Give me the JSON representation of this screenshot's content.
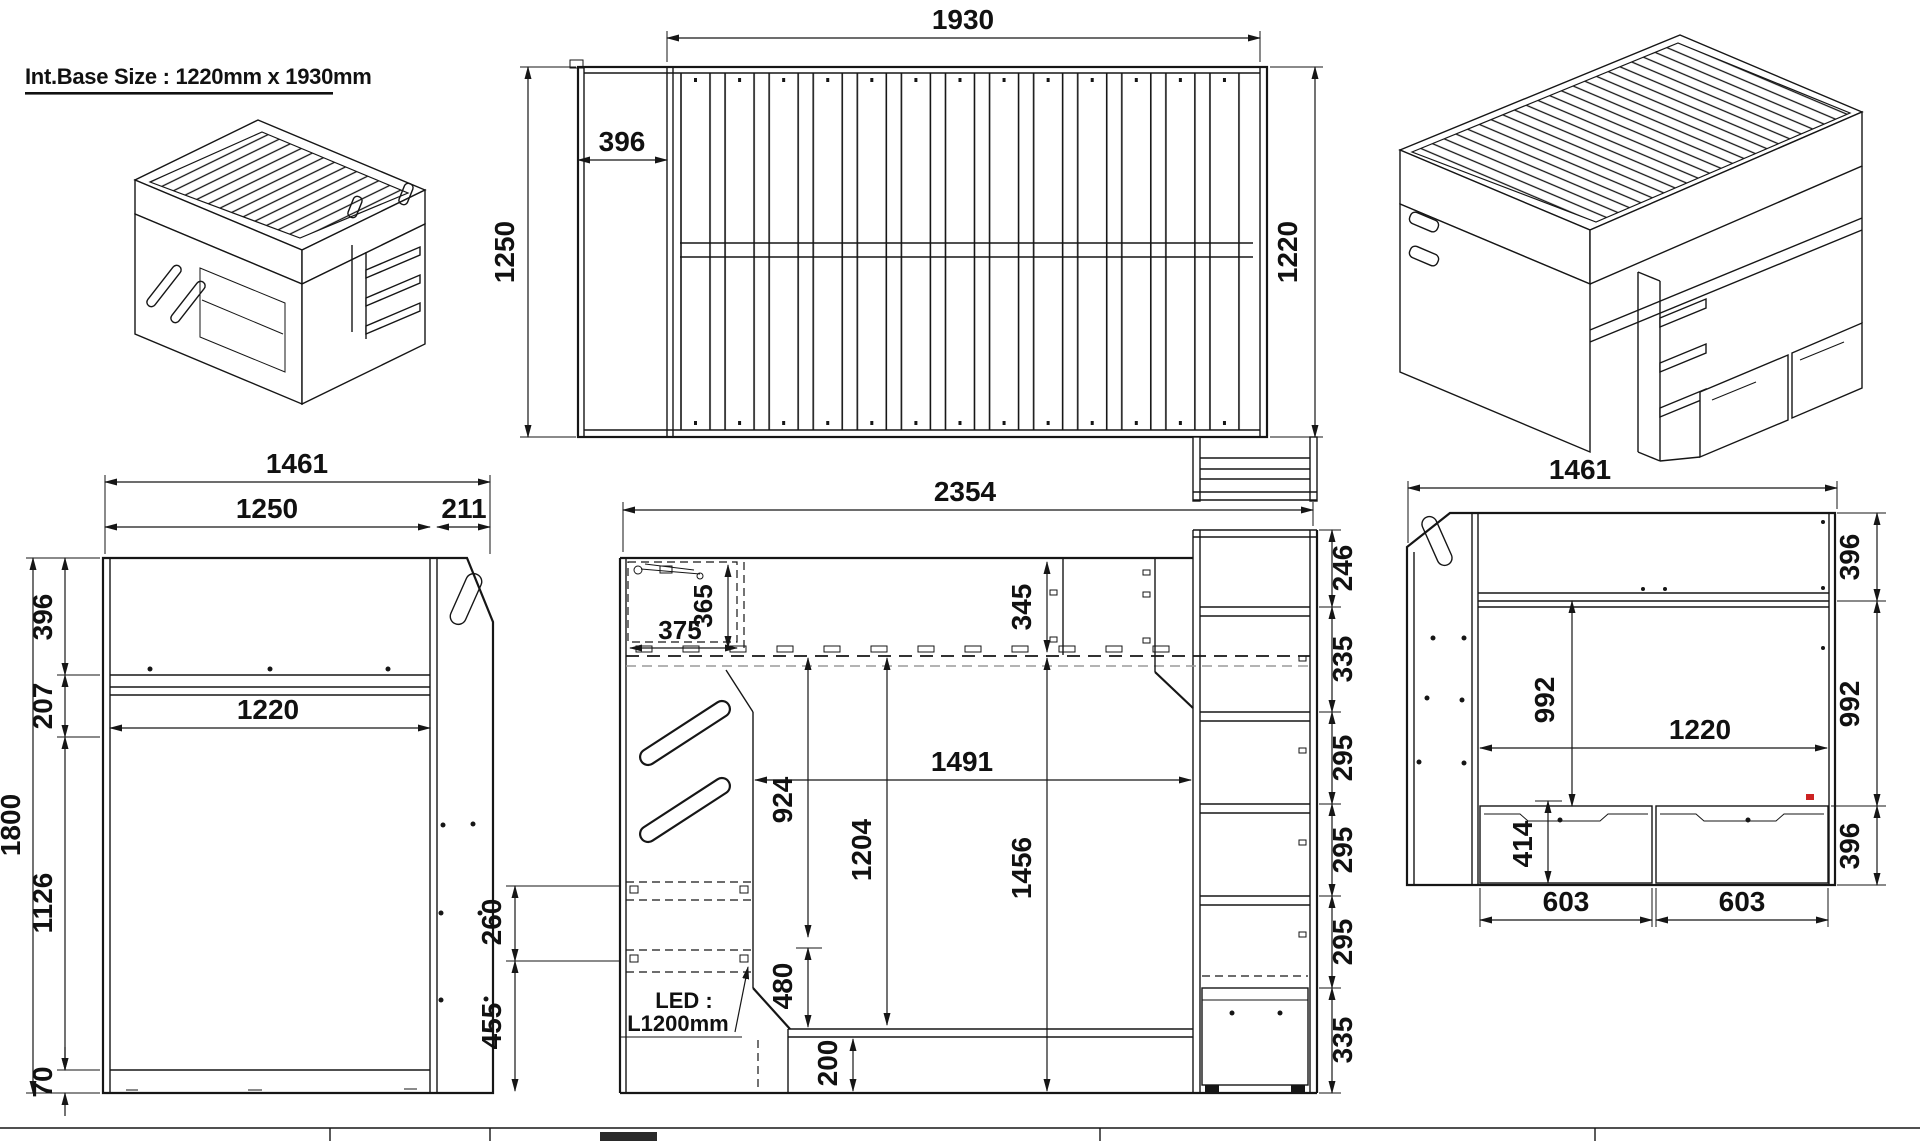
{
  "sheet": {
    "background": "#ffffff",
    "line_color": "#161616",
    "red_accent": "#cc2222"
  },
  "title": {
    "text": "Int.Base Size : 1220mm x 1930mm"
  },
  "plan_view": {
    "dims": {
      "length": "1930",
      "head_width": "396",
      "depth": "1250",
      "width": "1220"
    }
  },
  "side_view_left": {
    "dims": {
      "overall_width": "1461",
      "body_width": "1250",
      "ladder_offset": "211",
      "upper_rail": "396",
      "rail_gap": "207",
      "interior_width": "1220",
      "overall_height": "1800",
      "under_bunk": "1126",
      "base": "70"
    }
  },
  "front_view": {
    "dims": {
      "overall_width": "2354",
      "cabinet_width": "375",
      "cabinet_height": "365",
      "top_rail": "345",
      "opening_width": "1491",
      "opening_height": "924",
      "bunk_clearance": "1204",
      "floor_clearance": "1456",
      "led_spacing": "260",
      "led_height": "455",
      "shelf": "480",
      "under_shelf": "200",
      "ladder_s1": "246",
      "ladder_s2": "335",
      "ladder_s3": "295",
      "ladder_s4": "295",
      "ladder_s5": "295",
      "ladder_s6": "335"
    },
    "led_note_line1": "LED :",
    "led_note_line2": "L1200mm"
  },
  "side_view_right": {
    "dims": {
      "overall_width": "1461",
      "top_rail": "396",
      "mid_panel": "992",
      "interior_height": "992",
      "interior_width": "1220",
      "drawer_height": "414",
      "base_rail": "396",
      "drawer1_width": "603",
      "drawer2_width": "603"
    }
  }
}
